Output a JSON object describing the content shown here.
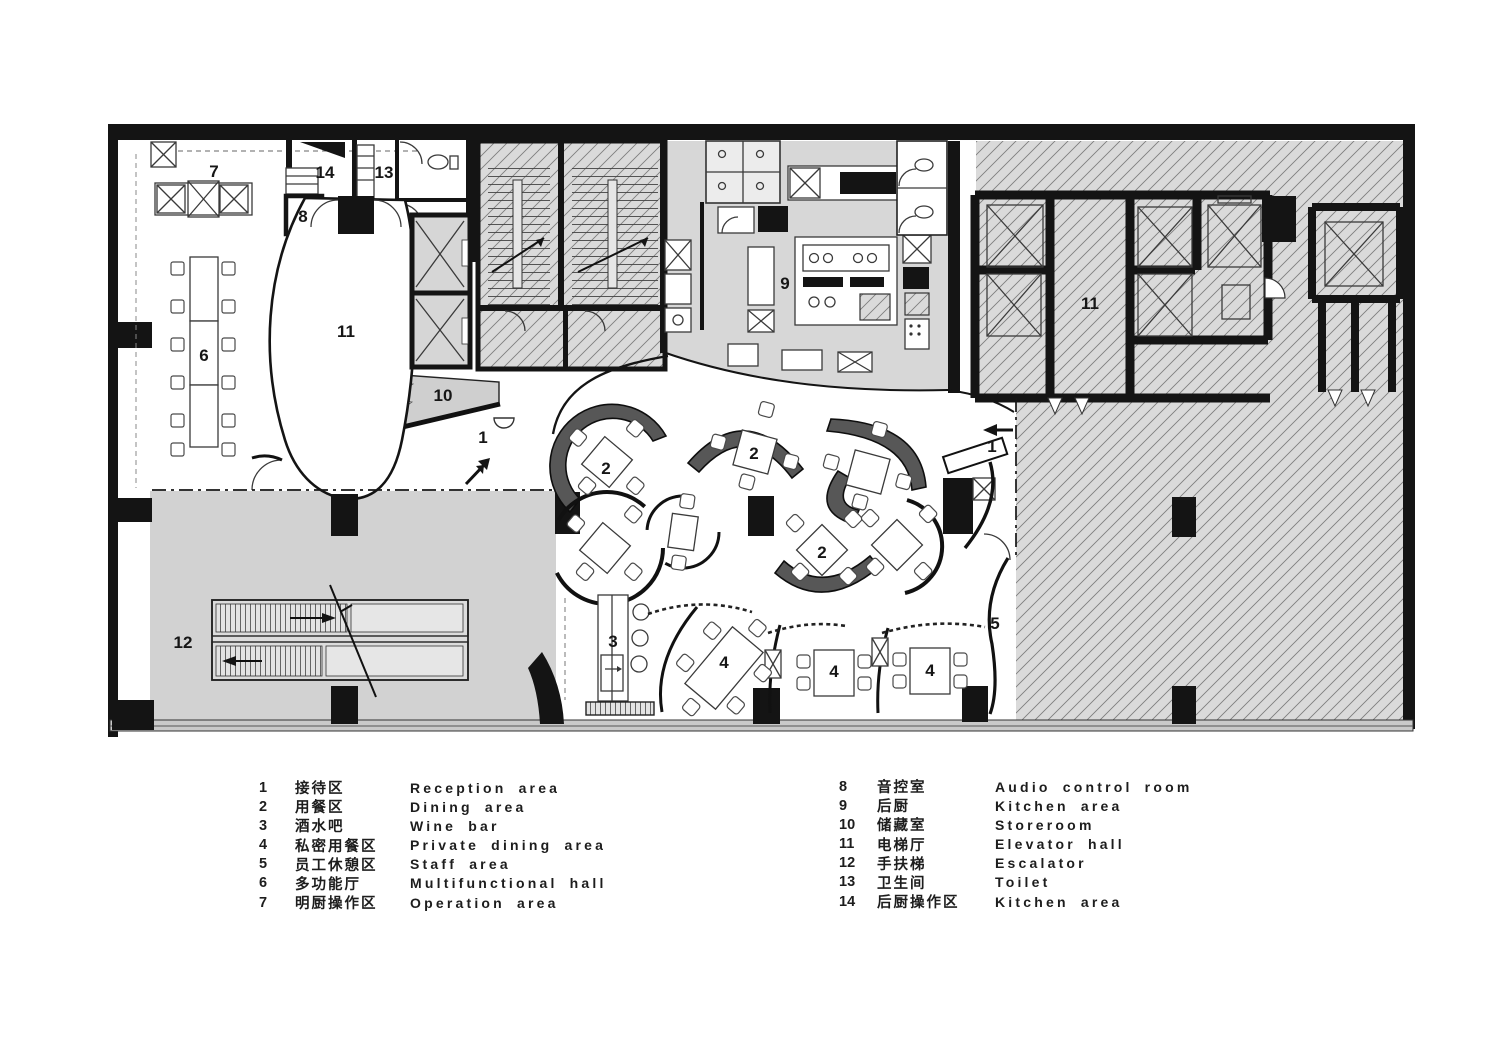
{
  "plan": {
    "room_labels": [
      {
        "n": "7",
        "x": 214,
        "y": 177
      },
      {
        "n": "14",
        "x": 325,
        "y": 178
      },
      {
        "n": "13",
        "x": 384,
        "y": 178
      },
      {
        "n": "8",
        "x": 303,
        "y": 222
      },
      {
        "n": "11",
        "x": 346,
        "y": 337
      },
      {
        "n": "6",
        "x": 204,
        "y": 361
      },
      {
        "n": "9",
        "x": 785,
        "y": 289
      },
      {
        "n": "11",
        "x": 1090,
        "y": 309
      },
      {
        "n": "10",
        "x": 443,
        "y": 401
      },
      {
        "n": "1",
        "x": 483,
        "y": 443
      },
      {
        "n": "1",
        "x": 992,
        "y": 452
      },
      {
        "n": "2",
        "x": 606,
        "y": 474
      },
      {
        "n": "2",
        "x": 754,
        "y": 459
      },
      {
        "n": "2",
        "x": 822,
        "y": 558
      },
      {
        "n": "3",
        "x": 613,
        "y": 647
      },
      {
        "n": "12",
        "x": 183,
        "y": 648
      },
      {
        "n": "4",
        "x": 724,
        "y": 668
      },
      {
        "n": "4",
        "x": 834,
        "y": 677
      },
      {
        "n": "4",
        "x": 930,
        "y": 676
      },
      {
        "n": "5",
        "x": 995,
        "y": 629
      }
    ]
  },
  "legend": {
    "left": [
      {
        "num": "1",
        "zh": "接待区",
        "en": "Reception area"
      },
      {
        "num": "2",
        "zh": "用餐区",
        "en": "Dining area"
      },
      {
        "num": "3",
        "zh": "酒水吧",
        "en": "Wine bar"
      },
      {
        "num": "4",
        "zh": "私密用餐区",
        "en": "Private dining area"
      },
      {
        "num": "5",
        "zh": "员工休憩区",
        "en": "Staff area"
      },
      {
        "num": "6",
        "zh": "多功能厅",
        "en": "Multifunctional hall"
      },
      {
        "num": "7",
        "zh": "明厨操作区",
        "en": "Operation area"
      }
    ],
    "right": [
      {
        "num": "8",
        "zh": "音控室",
        "en": "Audio control room"
      },
      {
        "num": "9",
        "zh": "后厨",
        "en": "Kitchen area"
      },
      {
        "num": "10",
        "zh": "储藏室",
        "en": "Storeroom"
      },
      {
        "num": "11",
        "zh": "电梯厅",
        "en": "Elevator hall"
      },
      {
        "num": "12",
        "zh": "手扶梯",
        "en": "Escalator"
      },
      {
        "num": "13",
        "zh": "卫生间",
        "en": "Toilet"
      },
      {
        "num": "14",
        "zh": "后厨操作区",
        "en": "Kitchen area"
      }
    ]
  }
}
